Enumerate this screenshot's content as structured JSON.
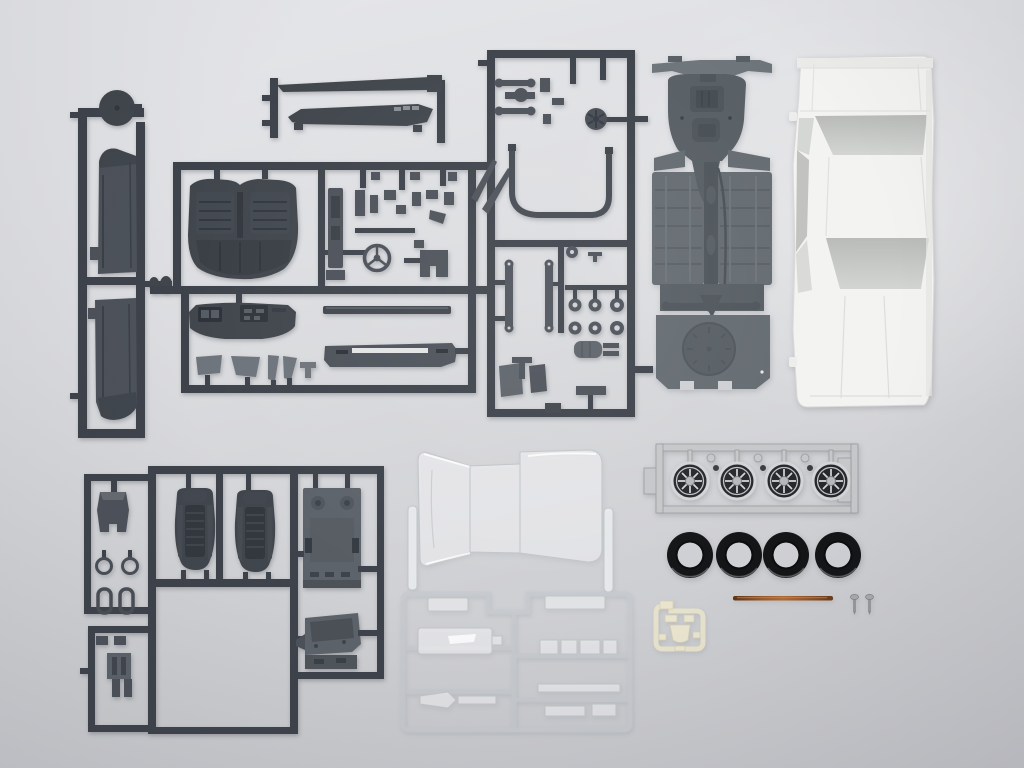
{
  "scene": {
    "description": "Unassembled plastic model car kit parts laid out flat on a light gray seamless surface, photographed from above",
    "background_color": "#d7d8db"
  },
  "colors": {
    "dark_sprue_plastic": "#3e434b",
    "medium_part_gray": "#4d525a",
    "chassis_gray": "#646b71",
    "body_white": "#f3f3f1",
    "window_opening_gray": "#c5c7c5",
    "chrome_silver": "#c5c7c9",
    "wheel_face_dark": "#26282c",
    "tire_black": "#141517",
    "clear_part_edge": "#c2c5c9",
    "axle_copper": "#8e5128",
    "screw_silver": "#9da0a3",
    "lens_cream": "#e9e4ce"
  },
  "counts": {
    "tires": 4,
    "wheels": 4,
    "screws": 2,
    "bucket_seats": 2,
    "rocker_panels": 2
  },
  "parts": {
    "side_panel_sprue": {
      "label": "dark gray sprue with round spare-wheel disc and two long rocker side panels"
    },
    "window_frame_sprue": {
      "label": "dark gray sprue with two window frame and bumper strips"
    },
    "interior_sprue": {
      "label": "dark gray sprue with rear bench seat, dashboard, console, steering wheel, pillars and rear bumper"
    },
    "engine_sprue": {
      "label": "dark gray sprue with suspension arms, cooling fan, exhaust pipes, leaf springs, hubs and muffler"
    },
    "chassis_plate": {
      "label": "gray one-piece chassis floor pan with engine sump, driveshaft, rear axle and spare wheel well"
    },
    "body_shell": {
      "label": "white sedan body shell seen from above with open window apertures"
    },
    "seat_sprue": {
      "label": "dark gray sprue with two bucket seats, console tunnel, rings and interior floor brackets"
    },
    "clear_glass": {
      "label": "clear one-piece windshield, roof and rear glass unit with two clear posts"
    },
    "clear_sprue": {
      "label": "clear sprue frame holding window glazing and lamp lenses"
    },
    "wheel_sprue": {
      "label": "chrome plated sprue holding four mesh-spoke wheels and small hub caps"
    },
    "tires": {
      "label": "four black rubber tires"
    },
    "axle_rod": {
      "label": "copper colored metal axle rod"
    },
    "screws": {
      "label": "two small silver metal screws"
    },
    "lens_part": {
      "label": "small cream colored lamp lens sprue"
    }
  }
}
